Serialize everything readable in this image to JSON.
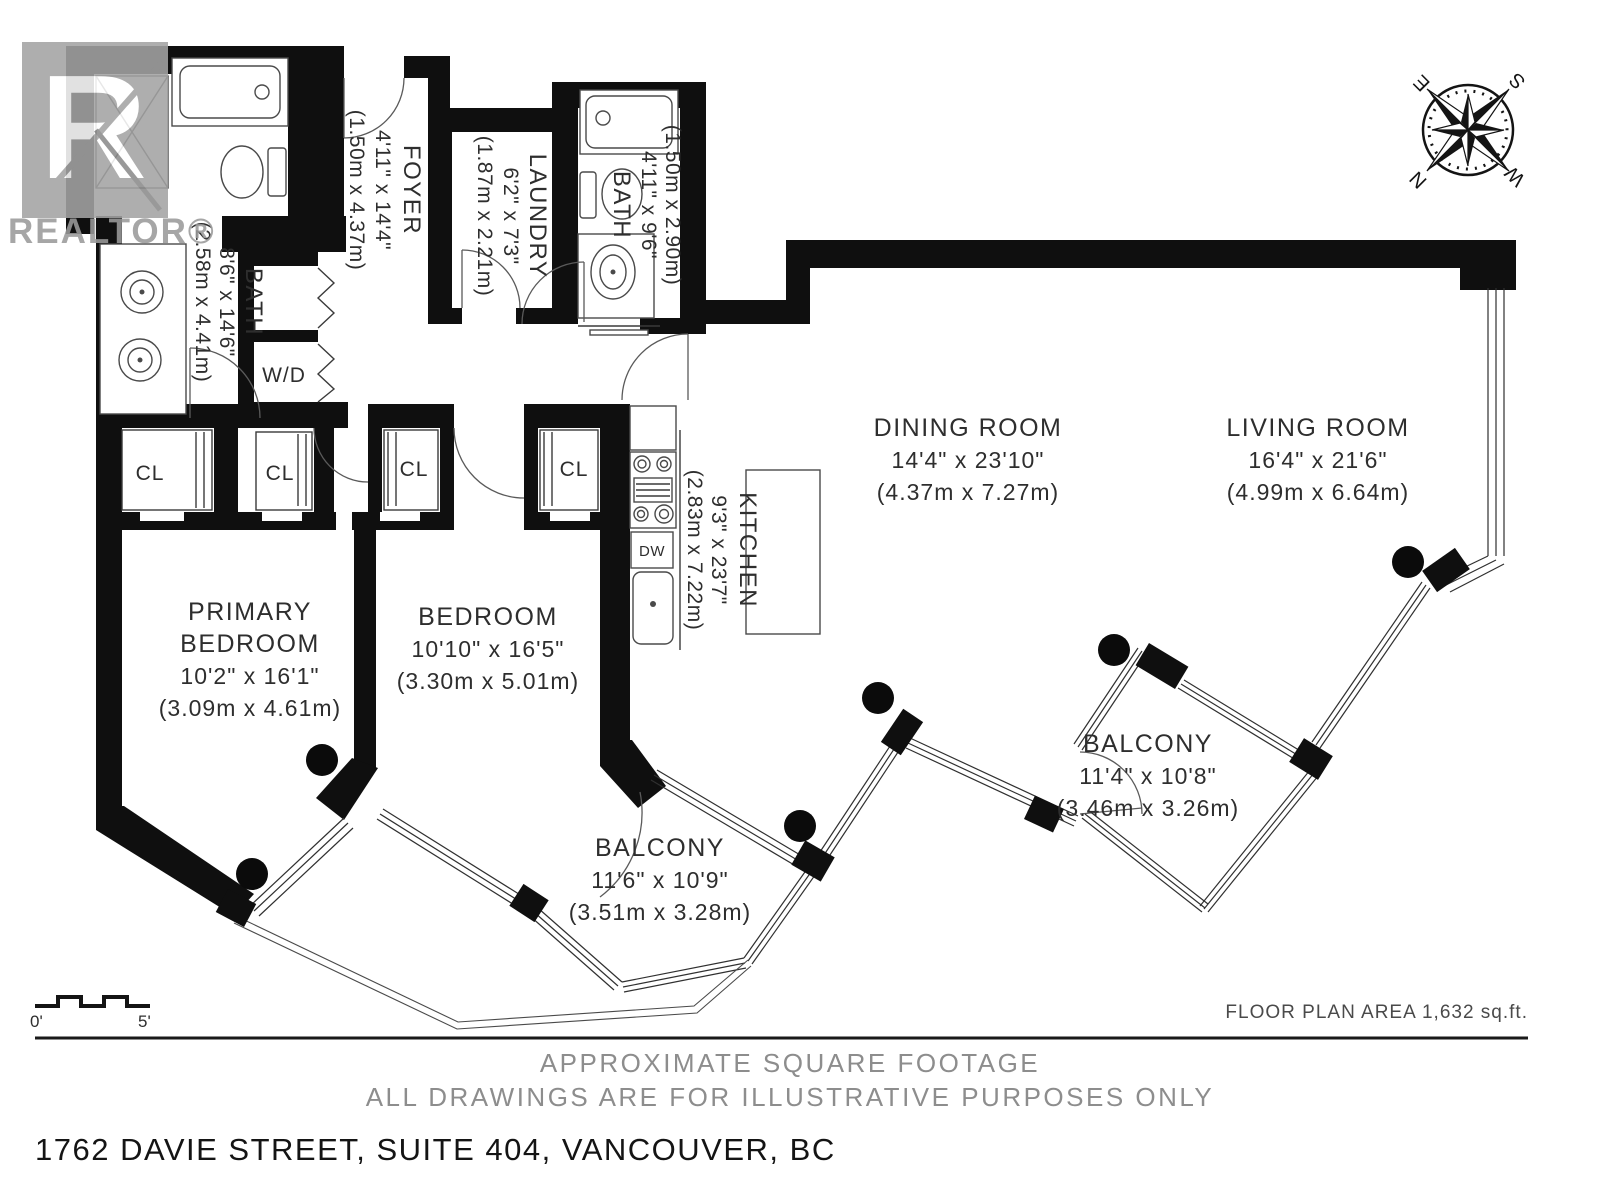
{
  "branding": {
    "logo_letter": "R",
    "logo_text": "REALTOR®"
  },
  "compass": {
    "n": "N",
    "e": "E",
    "s": "S",
    "w": "W"
  },
  "rooms": {
    "foyer": {
      "name": "FOYER",
      "imperial": "4'11\" x 14'4\"",
      "metric": "(1.50m x 4.37m)"
    },
    "laundry": {
      "name": "LAUNDRY",
      "imperial": "6'2\" x 7'3\"",
      "metric": "(1.87m x 2.21m)"
    },
    "bath_main": {
      "name": "BATH",
      "imperial": "8'6\" x 14'6\"",
      "metric": "(2.58m x 4.41m)"
    },
    "bath_second": {
      "name": "BATH",
      "imperial": "4'11\" x 9'6\"",
      "metric": "(1.50m x 2.90m)"
    },
    "primary_bedroom": {
      "name_line1": "PRIMARY",
      "name_line2": "BEDROOM",
      "imperial": "10'2\" x 16'1\"",
      "metric": "(3.09m x 4.61m)"
    },
    "bedroom": {
      "name": "BEDROOM",
      "imperial": "10'10\" x 16'5\"",
      "metric": "(3.30m x 5.01m)"
    },
    "kitchen": {
      "name": "KITCHEN",
      "imperial": "9'3\" x 23'7\"",
      "metric": "(2.83m x 7.22m)"
    },
    "dining_room": {
      "name": "DINING ROOM",
      "imperial": "14'4\" x 23'10\"",
      "metric": "(4.37m x 7.27m)"
    },
    "living_room": {
      "name": "LIVING ROOM",
      "imperial": "16'4\" x 21'6\"",
      "metric": "(4.99m x 6.64m)"
    },
    "balcony_lower": {
      "name": "BALCONY",
      "imperial": "11'6\" x 10'9\"",
      "metric": "(3.51m x 3.28m)"
    },
    "balcony_upper": {
      "name": "BALCONY",
      "imperial": "11'4\" x 10'8\"",
      "metric": "(3.46m x 3.26m)"
    }
  },
  "fixtures": {
    "closet": "CL",
    "washer_dryer": "W/D",
    "dishwasher": "DW"
  },
  "scale_bar": {
    "start": "0'",
    "end": "5'"
  },
  "footer": {
    "area": "FLOOR PLAN AREA 1,632 sq.ft.",
    "disclaimer_line1": "APPROXIMATE SQUARE FOOTAGE",
    "disclaimer_line2": "ALL DRAWINGS ARE FOR ILLUSTRATIVE PURPOSES ONLY",
    "address": "1762 DAVIE STREET, SUITE 404, VANCOUVER, BC"
  }
}
